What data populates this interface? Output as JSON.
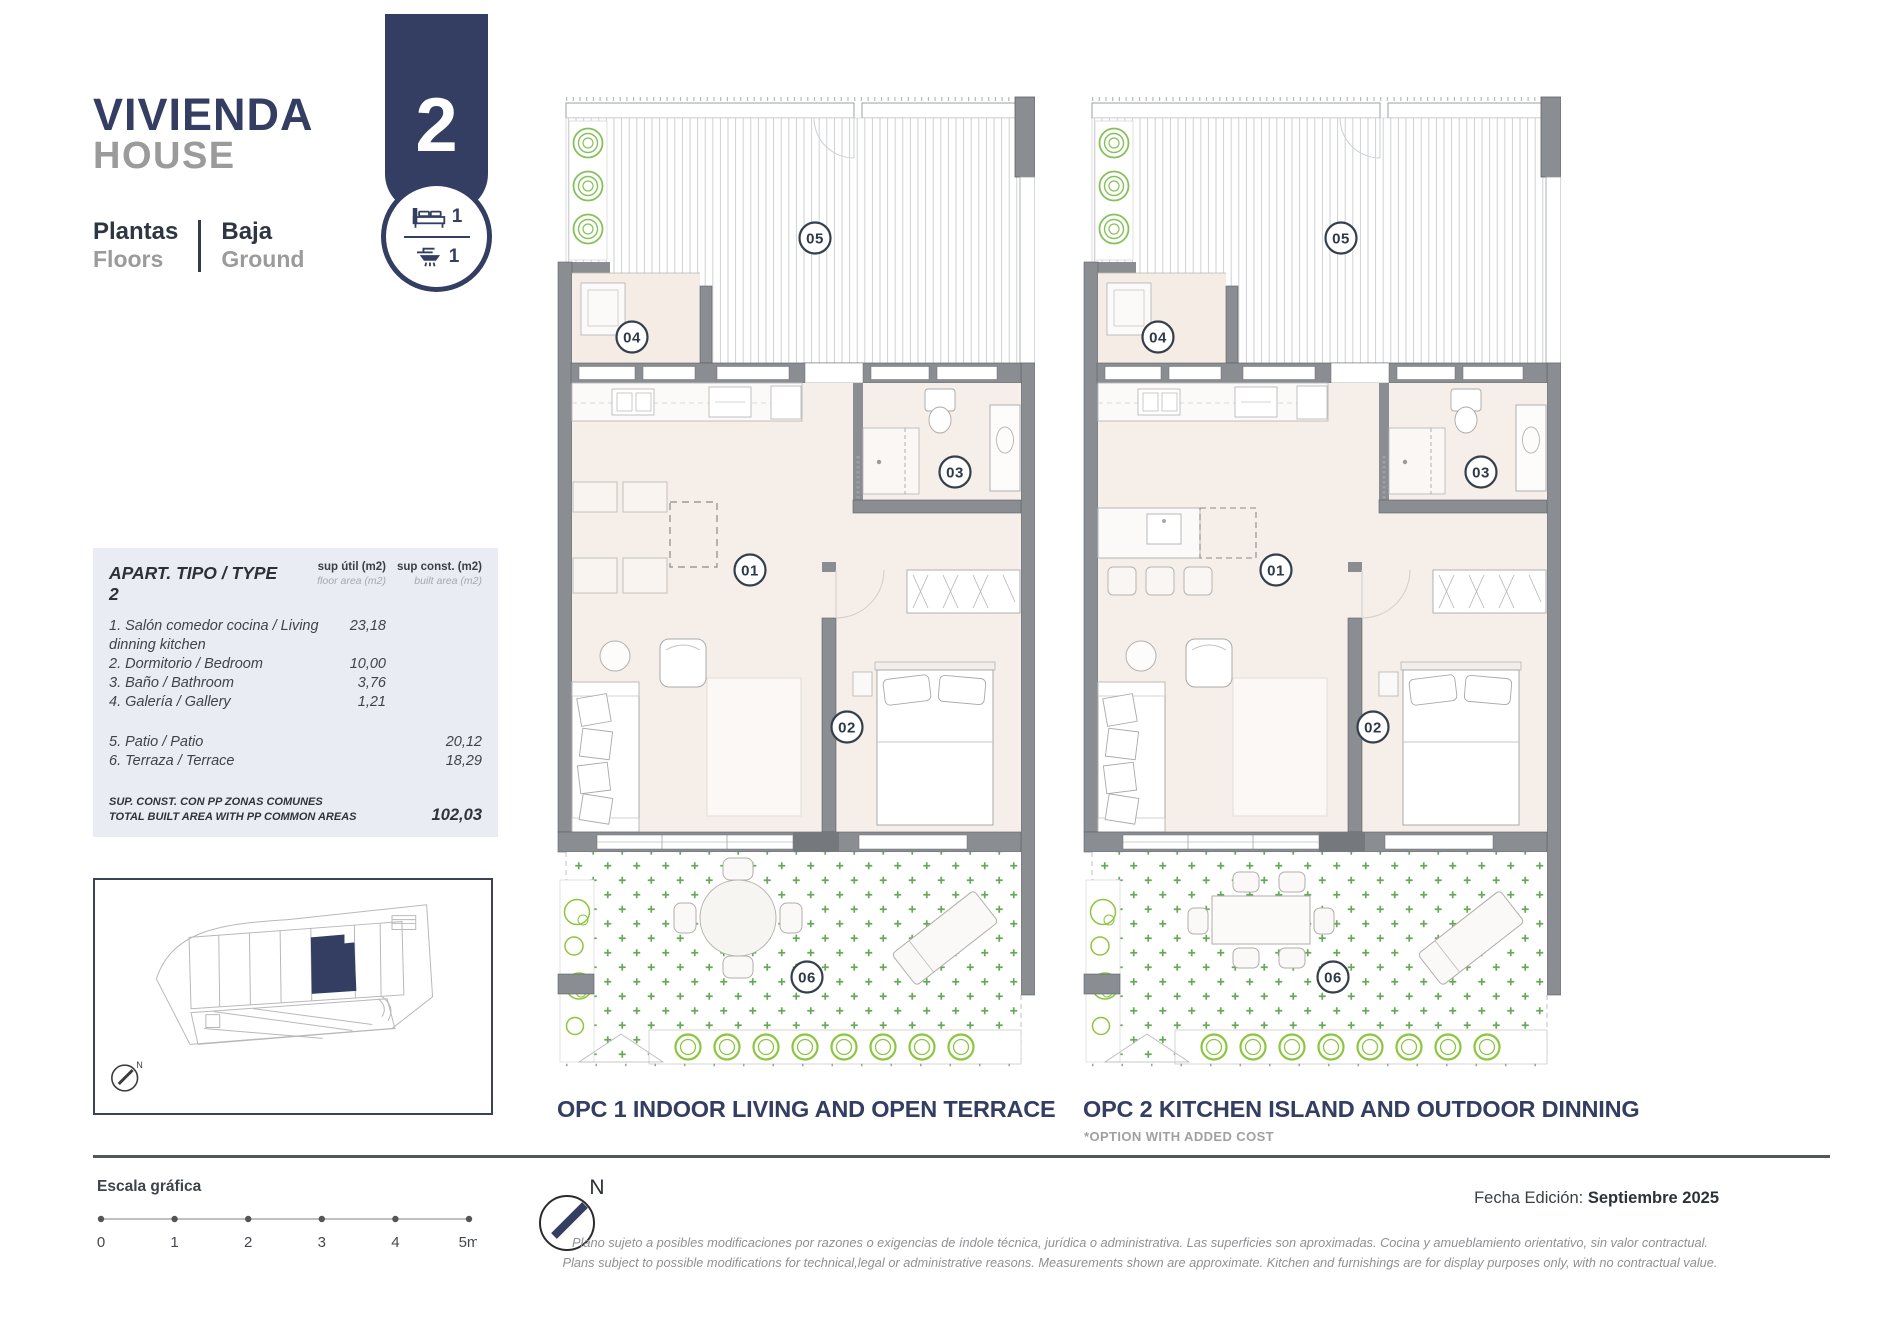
{
  "header": {
    "title_es": "VIVIENDA",
    "title_en": "HOUSE",
    "floors_label_es": "Plantas",
    "floors_label_en": "Floors",
    "floor_value_es": "Baja",
    "floor_value_en": "Ground",
    "unit_number": "2",
    "bedrooms_count": "1",
    "bathrooms_count": "1"
  },
  "area_table": {
    "title": "APART. TIPO / TYPE 2",
    "col_util_line1": "sup útil (m2)",
    "col_util_line2": "floor area (m2)",
    "col_const_line1": "sup const. (m2)",
    "col_const_line2": "built area (m2)",
    "rows": [
      {
        "label": "1. Salón comedor cocina / Living dinning kitchen",
        "util": "23,18",
        "const": ""
      },
      {
        "label": "2. Dormitorio / Bedroom",
        "util": "10,00",
        "const": ""
      },
      {
        "label": "3. Baño / Bathroom",
        "util": "3,76",
        "const": ""
      },
      {
        "label": "4. Galería / Gallery",
        "util": "1,21",
        "const": ""
      },
      {
        "label": "5. Patio / Patio",
        "util": "",
        "const": "20,12"
      },
      {
        "label": "6. Terraza / Terrace",
        "util": "",
        "const": "18,29"
      }
    ],
    "total_label_line1": "SUP. CONST. CON PP ZONAS COMUNES",
    "total_label_line2": "TOTAL BUILT AREA WITH PP COMMON AREAS",
    "total_value": "102,03"
  },
  "rooms": {
    "r1": "01",
    "r2": "02",
    "r3": "03",
    "r4": "04",
    "r5": "05",
    "r6": "06"
  },
  "plans": {
    "opc1_label": "OPC 1 INDOOR LIVING AND OPEN TERRACE",
    "opc2_label": "OPC 2 KITCHEN ISLAND AND OUTDOOR DINNING",
    "opc2_note": "*OPTION WITH ADDED COST"
  },
  "footer": {
    "scale_label": "Escala gráfica",
    "scale_ticks": [
      "0",
      "1",
      "2",
      "3",
      "4",
      "5m"
    ],
    "north_label": "N",
    "date_label": "Fecha Edición:",
    "date_value": "Septiembre 2025",
    "disclaimer_es": "Plano sujeto a posibles modificaciones por razones o exigencias de índole técnica,  jurídica o administrativa. Las superficies son aproximadas. Cocina y amueblamiento orientativo, sin valor contractual.",
    "disclaimer_en": "Plans subject to possible modifications for technical,legal or administrative reasons. Measurements shown are approximate. Kitchen and furnishings are for display purposes only, with no contractual value."
  },
  "colors": {
    "navy": "#333e62",
    "gray": "#9b9b9b",
    "wall": "#8a8e92",
    "interior": "#f6eee8",
    "green": "#8cc63f",
    "tablebg": "#e9ecf3"
  }
}
